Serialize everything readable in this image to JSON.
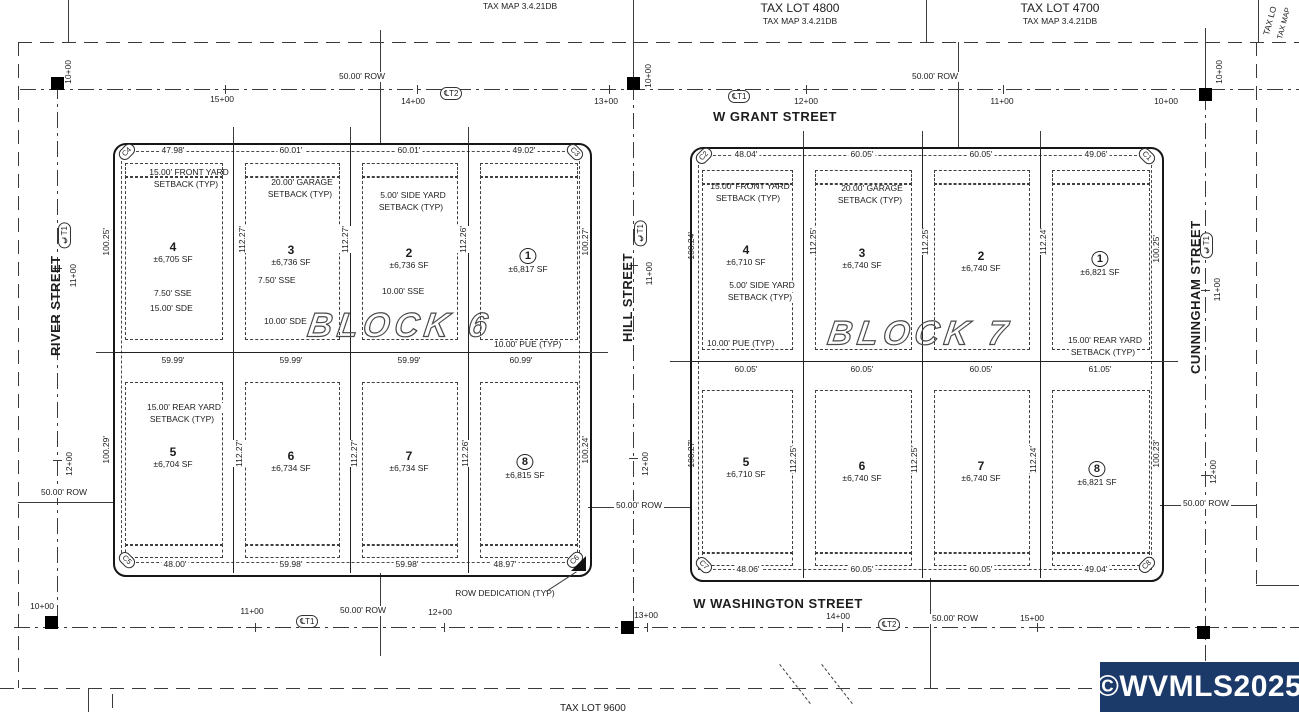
{
  "tax": {
    "map_left": "TAX MAP 3.4.21DB",
    "lot_4800": "TAX LOT 4800",
    "map_4800": "TAX MAP 3.4.21DB",
    "lot_4700": "TAX LOT 4700",
    "map_4700": "TAX MAP 3.4.21DB",
    "corner_lot_partial": "TAX LO",
    "corner_map_partial": "TAX MAP",
    "south_lot_partial": "TAX LOT 9600"
  },
  "streets": {
    "grant": "W GRANT STREET",
    "washington": "W WASHINGTON STREET",
    "river": "RIVER STREET",
    "hill": "HILL STREET",
    "cunningham": "CUNNINGHAM STREET"
  },
  "labels": {
    "row": "50.00' ROW",
    "cl_t1": "℄T1",
    "cl_t2": "℄T2",
    "row_dedication": "ROW DEDICATION (TYP)"
  },
  "stations": {
    "s10": "10+00",
    "s11": "11+00",
    "s12": "12+00",
    "s13": "13+00",
    "s14": "14+00",
    "s15": "15+00"
  },
  "annotations": {
    "front_yard_l1": "15.00' FRONT YARD",
    "front_yard_l2": "SETBACK (TYP)",
    "garage_l1": "20.00' GARAGE",
    "garage_l2": "SETBACK (TYP)",
    "side_yard_l1": "5.00' SIDE YARD",
    "side_yard_l2": "SETBACK (TYP)",
    "rear_yard_l1": "15.00' REAR YARD",
    "rear_yard_l2": "SETBACK (TYP)",
    "sse_750": "7.50' SSE",
    "sse_1000": "10.00' SSE",
    "sde_1500": "15.00' SDE",
    "sde_1000": "10.00' SDE",
    "pue": "10.00' PUE (TYP)"
  },
  "blocks": [
    {
      "title": "BLOCK 6",
      "corners": [
        "C4",
        "C3",
        "C5",
        "C6"
      ],
      "top_dims": [
        "47.98'",
        "60.01'",
        "60.01'",
        "49.02'"
      ],
      "mid_dims": [
        "59.99'",
        "59.99'",
        "59.99'",
        "60.99'"
      ],
      "bottom_dims": [
        "48.00'",
        "59.98'",
        "59.98'",
        "48.97'"
      ],
      "left_dims": [
        "100.25'",
        "100.29'"
      ],
      "right_dims": [
        "100.27'",
        "100.24'"
      ],
      "inner_top_dims": [
        "112.27'",
        "112.27'",
        "112.26'"
      ],
      "inner_bottom_dims": [
        "112.27'",
        "112.27'",
        "112.26'"
      ],
      "lots": [
        {
          "num": "4",
          "sf": "±6,705 SF"
        },
        {
          "num": "3",
          "sf": "±6,736 SF"
        },
        {
          "num": "2",
          "sf": "±6,736 SF"
        },
        {
          "num": "1",
          "sf": "±6,817 SF"
        },
        {
          "num": "5",
          "sf": "±6,704 SF"
        },
        {
          "num": "6",
          "sf": "±6,734 SF"
        },
        {
          "num": "7",
          "sf": "±6,734 SF"
        },
        {
          "num": "8",
          "sf": "±6,815 SF"
        }
      ]
    },
    {
      "title": "BLOCK 7",
      "corners": [
        "C2",
        "C1",
        "C7",
        "C8"
      ],
      "top_dims": [
        "48.04'",
        "60.05'",
        "60.05'",
        "49.06'"
      ],
      "mid_dims": [
        "60.05'",
        "60.05'",
        "60.05'",
        "61.05'"
      ],
      "bottom_dims": [
        "48.06'",
        "60.05'",
        "60.05'",
        "49.04'"
      ],
      "left_dims": [
        "100.24'",
        "100.27'"
      ],
      "right_dims": [
        "100.25'",
        "100.23'"
      ],
      "inner_top_dims": [
        "112.25'",
        "112.25'",
        "112.24'"
      ],
      "inner_bottom_dims": [
        "112.25'",
        "112.25'",
        "112.24'"
      ],
      "lots": [
        {
          "num": "4",
          "sf": "±6,710 SF"
        },
        {
          "num": "3",
          "sf": "±6,740 SF"
        },
        {
          "num": "2",
          "sf": "±6,740 SF"
        },
        {
          "num": "1",
          "sf": "±6,821 SF"
        },
        {
          "num": "5",
          "sf": "±6,710 SF"
        },
        {
          "num": "6",
          "sf": "±6,740 SF"
        },
        {
          "num": "7",
          "sf": "±6,740 SF"
        },
        {
          "num": "8",
          "sf": "±6,821 SF"
        }
      ]
    }
  ],
  "watermark": "©WVMLS2025",
  "colors": {
    "ink": "#1d1d1d",
    "line": "#3a3a3a",
    "watermark_bg": "#1c3a69",
    "watermark_text": "#ffffff"
  }
}
